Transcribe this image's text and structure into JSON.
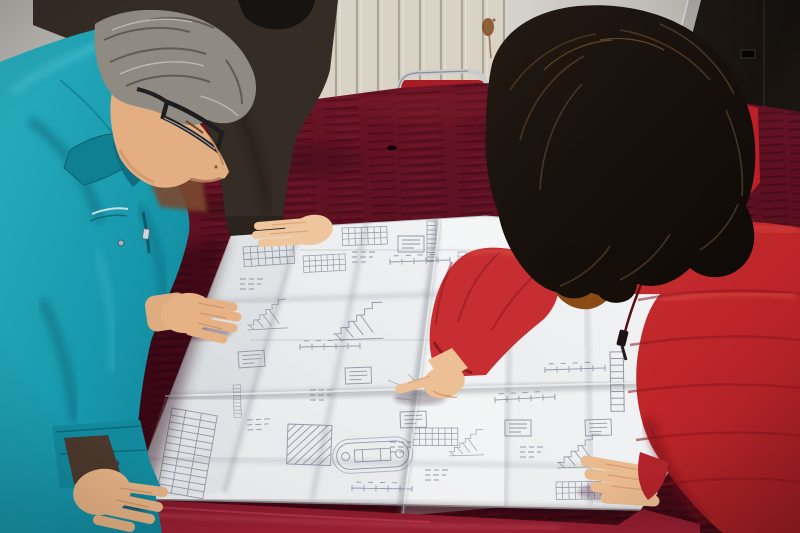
{
  "meta": {
    "title": "Two workers reviewing a large folded construction blueprint spread on a dark red velvet-covered table",
    "type": "photograph"
  },
  "scene": {
    "background": {
      "wall": "beige panelled wall with vertical radiator grooves",
      "door": "very dark brown door on the right with gray frame strip",
      "stain": "rust stain with drip on the wall"
    },
    "furniture": {
      "table": "large table draped in dark maroon velvet cloth",
      "chair": "chrome-framed chair with red backrest behind the table"
    },
    "blueprint": {
      "description": "large white folded engineering drawing with stair sections, detail views, dimension strings and schedule tables",
      "fold_columns": 4,
      "fold_rows": 3
    },
    "people": [
      {
        "id": "engineer-left",
        "description": "gray-haired man with dark glasses in a teal work jacket leaning on the table with both hands"
      },
      {
        "id": "colleague-behind",
        "description": "person in a dark jacket partly hidden behind the man, one hand resting on the drawing"
      },
      {
        "id": "woman-right",
        "description": "woman with long dark wavy hair in a red padded coat with orange fur-trimmed hood, pointing at the drawing with her index finger"
      }
    ],
    "colors": {
      "velvet": "#5e1120",
      "velvet_bright": "#8e1b2c",
      "teal_jacket": "#1ba4b6",
      "red_coat": "#c2292e",
      "fur": "#e08a28",
      "paper": "#ecedef",
      "wall": "#d7d2c6",
      "door": "#18130f",
      "woman_hair": "#1c1410",
      "man_hair": "#948e86"
    }
  }
}
